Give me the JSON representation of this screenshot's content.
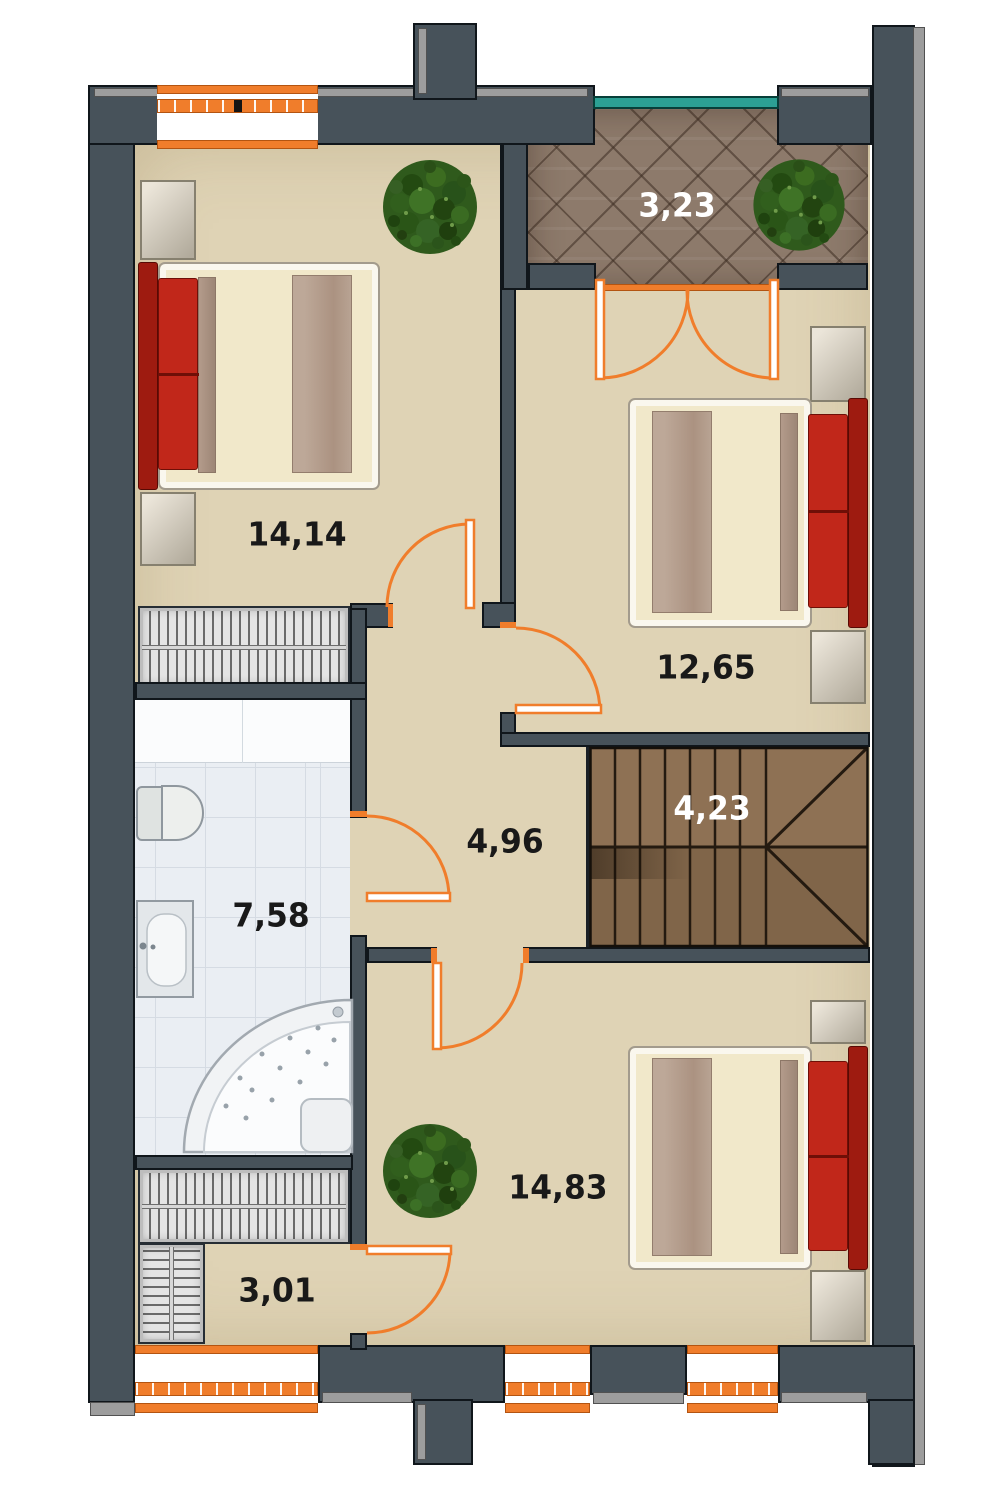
{
  "floor_plan": {
    "rooms": [
      {
        "name": "bedroom-upper-left",
        "area_label": "14,14",
        "label_color": "#191919"
      },
      {
        "name": "balcony",
        "area_label": "3,23",
        "label_color": "#ffffff"
      },
      {
        "name": "bedroom-right",
        "area_label": "12,65",
        "label_color": "#191919"
      },
      {
        "name": "hallway",
        "area_label": "4,96",
        "label_color": "#191919"
      },
      {
        "name": "staircase",
        "area_label": "4,23",
        "label_color": "#ffffff"
      },
      {
        "name": "bathroom",
        "area_label": "7,58",
        "label_color": "#191919"
      },
      {
        "name": "bedroom-lower",
        "area_label": "14,83",
        "label_color": "#191919"
      },
      {
        "name": "wardrobe-room",
        "area_label": "3,01",
        "label_color": "#191919"
      }
    ],
    "icons": [
      "plant-icon",
      "plant-icon",
      "plant-icon"
    ],
    "palette": {
      "wall": "#47525a",
      "wall_outer_edge": "#9d9d9d",
      "outline": "#10161b",
      "floor": "#dfd3b5",
      "accent_orange": "#f07d2b",
      "railing_teal": "#2ca094",
      "balcony_tile": "#8d7a6b",
      "stair_wood": "#8e7154",
      "bathroom_tile": "#eaeef3",
      "furniture_red": "#c1271a",
      "bed_cream": "#f1e8ca",
      "blanket_taupe": "#ab9281"
    }
  }
}
